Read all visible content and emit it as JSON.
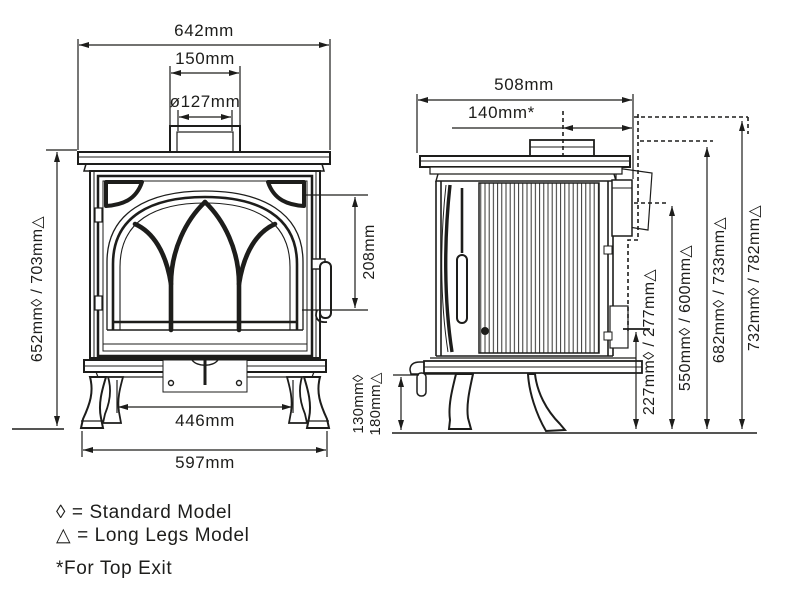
{
  "colors": {
    "line": "#1d1d1b",
    "background": "#ffffff"
  },
  "front_view": {
    "dims": {
      "overall_width": "642mm",
      "flue_collar_width": "150mm",
      "flue_diameter": "ø127mm",
      "height_to_top_plate": "652mm◊ / 703mm△",
      "door_glass_height": "208mm",
      "inner_leg_span": "446mm",
      "overall_base_width": "597mm"
    }
  },
  "side_view": {
    "dims": {
      "overall_depth": "508mm",
      "flue_centre_to_rear": "140mm*",
      "underside_clearance_standard": "130mm◊",
      "underside_clearance_long_legs": "180mm△",
      "rear_lower_outlet_height": "227mm◊ / 277mm△",
      "rear_flue_centre_height": "550mm◊ / 600mm△",
      "rear_exit_top_height": "682mm◊ / 733mm△",
      "overall_height": "732mm◊ / 782mm△"
    }
  },
  "legend": {
    "standard": "◊ = Standard Model",
    "long_legs": "△ = Long Legs Model",
    "footnote": "*For Top Exit"
  }
}
